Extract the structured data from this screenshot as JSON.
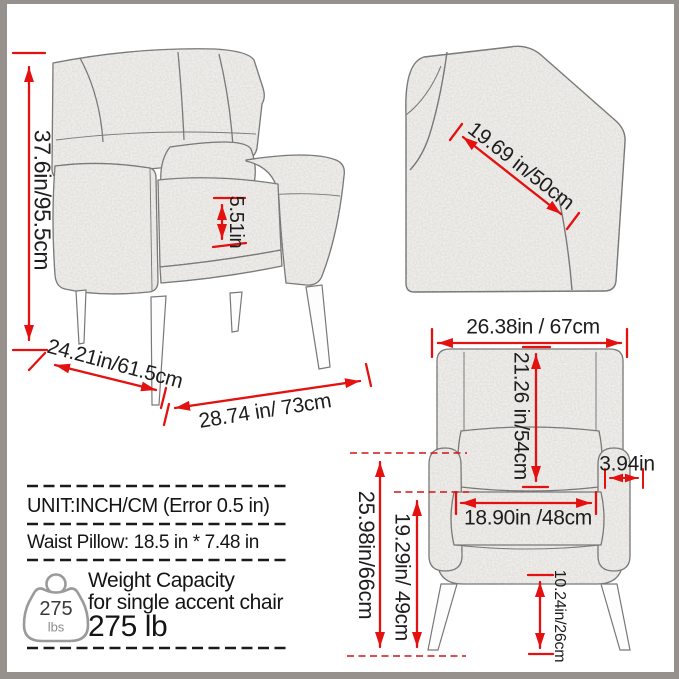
{
  "product": "accent chair dimension diagram",
  "dims": {
    "overall_height": "37.6in/95.5cm",
    "armrest_cushion_height": "5.51in",
    "depth": "24.21in/61.5cm",
    "width": "28.74 in/ 73cm",
    "back_diagonal": "19.69 in/50cm",
    "top_width": "26.38in / 67cm",
    "back_height": "21.26 in/54cm",
    "arm_width": "3.94in",
    "seat_width": "18.90in /48cm",
    "arm_to_floor": "25.98in/66cm",
    "seat_to_floor": "19.29in/ 49cm",
    "leg_height": "10.24in/26cm"
  },
  "info": {
    "unit_line": "UNIT:INCH/CM (Error 0.5 in)",
    "pillow_line": "Waist Pillow: 18.5 in * 7.48 in",
    "weight_title": "Weight Capacity",
    "weight_subtitle": "for single accent chair",
    "weight_value": "275 lb",
    "weight_icon_value": "275",
    "weight_icon_unit": "lbs"
  },
  "icons": {
    "weight_icon": "kettlebell-weight-icon"
  },
  "colors": {
    "dimension_red": "#e41111",
    "text_ink": "#1d1d1d",
    "sketch_gray": "#6f6f6f",
    "chair_fill": "#f2f0ed",
    "icon_gray": "#9a9a9a",
    "frame_gray": "#96918d"
  }
}
